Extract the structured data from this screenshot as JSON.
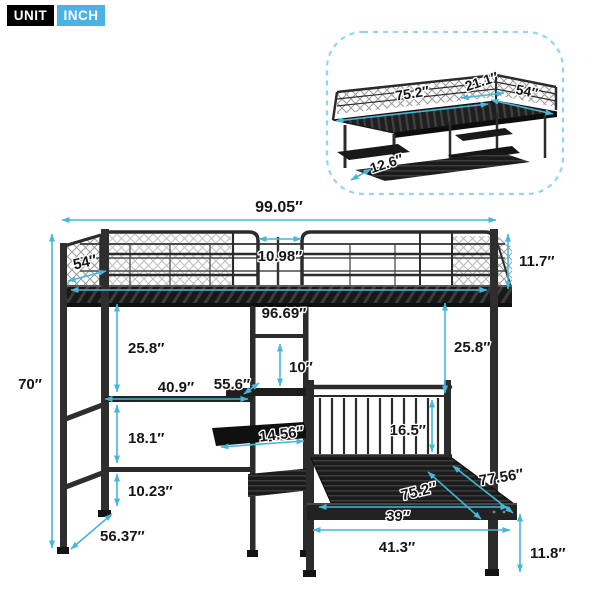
{
  "badges": {
    "unit": "UNIT",
    "inch": "INCH"
  },
  "colors": {
    "accent": "#44b7da",
    "badge_blue": "#4cb2e2",
    "frame": "#2b2b2b",
    "inset_border": "#90d7ee"
  },
  "inset": {
    "dims": {
      "top_length": "75.2″",
      "top_extension": "21.1″",
      "top_depth": "54″",
      "lower_shelf_depth": "12.6″"
    }
  },
  "main": {
    "dims": {
      "overall_length": "99.05″",
      "guard_gap": "10.98″",
      "guard_height": "11.7″",
      "loft_depth": "54″",
      "sleep_length": "96.69″",
      "left_clearance": "25.8″",
      "right_clearance": "25.8″",
      "overall_height": "70″",
      "desk_length": "40.9″",
      "desk_depth": "55.6″",
      "shelf_spacing": "10″",
      "desk_to_shelf": "18.1″",
      "shelf_depth": "14.56″",
      "headboard_height": "16.5″",
      "shelf_to_floor": "10.23″",
      "base_depth": "56.37″",
      "bed_length": "75.2″",
      "bed_total_depth": "77.56″",
      "bed_width": "39″",
      "bed_total_width": "41.3″",
      "leg_height": "11.8″"
    }
  }
}
